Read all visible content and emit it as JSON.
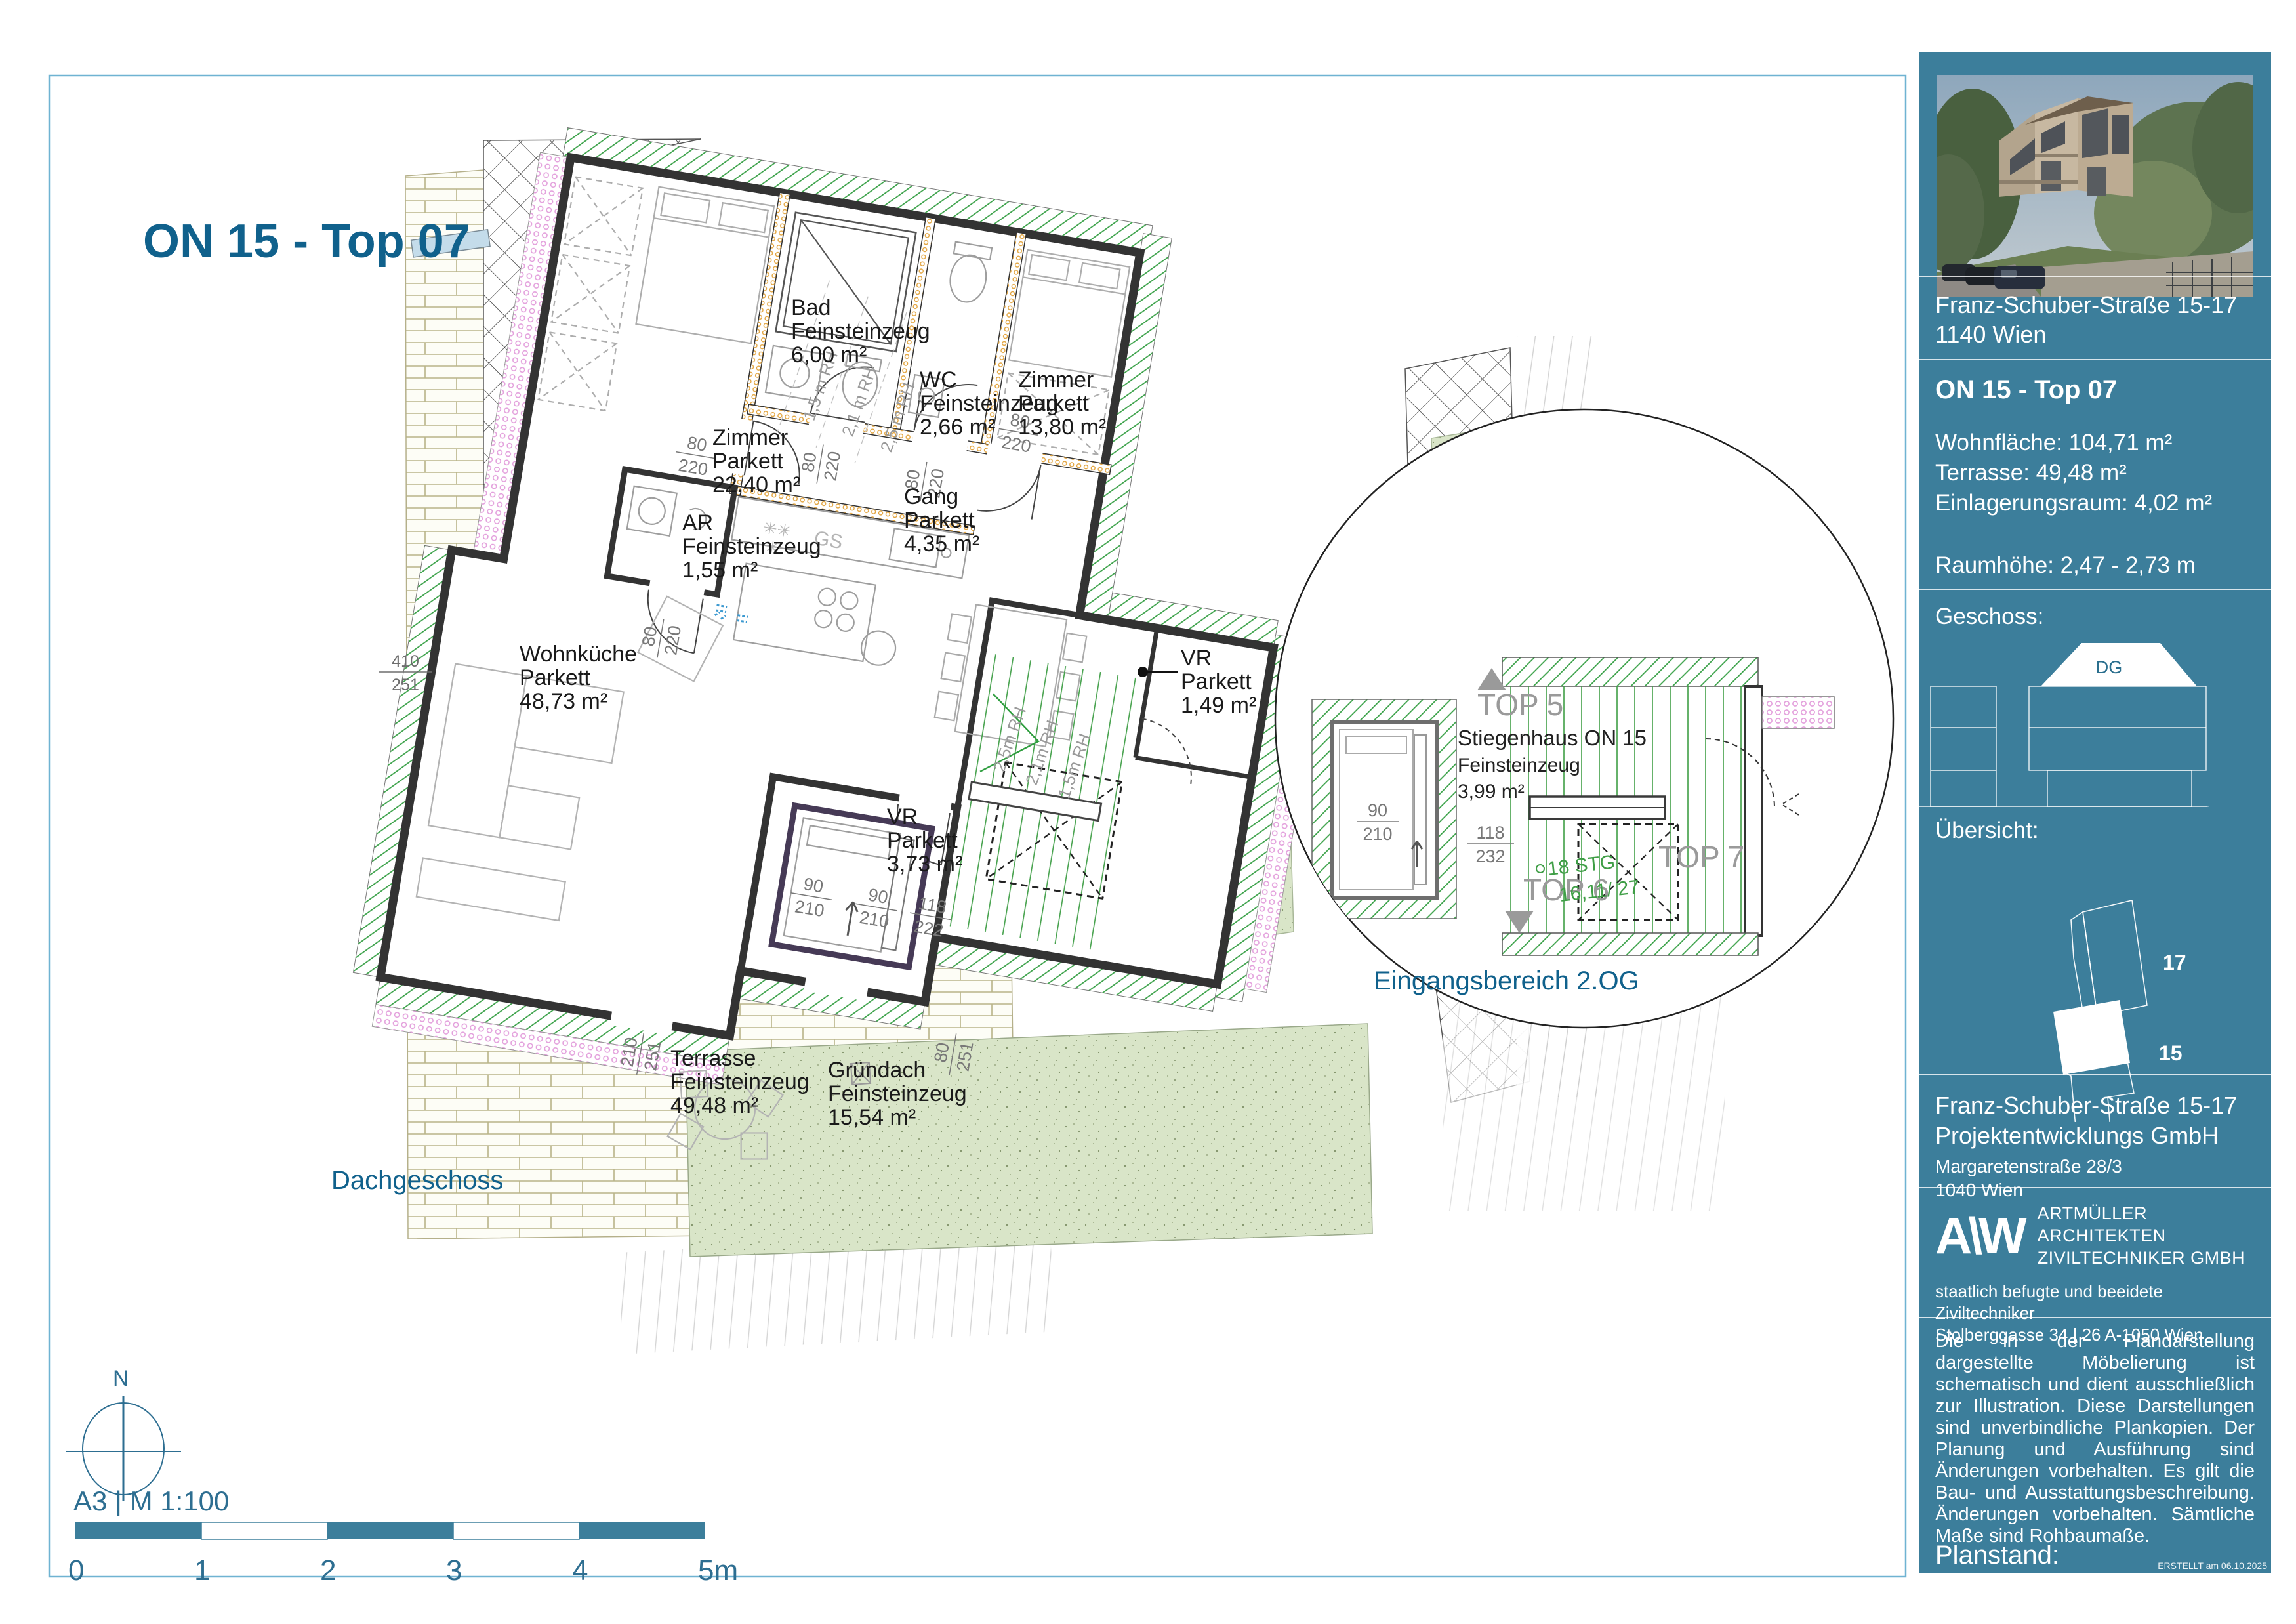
{
  "title": "ON 15 - Top 07",
  "plan": {
    "floor_label": "Dachgeschoss",
    "north_label": "N",
    "scale_text": "A3  |  M 1:100",
    "scale_ticks": [
      "0",
      "1",
      "2",
      "3",
      "4",
      "5m"
    ],
    "door_dim_w": "80",
    "door_dim_h": "220",
    "left_dim_top": "410",
    "left_dim_bot": "251",
    "bottom_dim1_top": "210",
    "bottom_dim1_bot": "251",
    "bottom_dim2_top": "80",
    "bottom_dim2_bot": "251",
    "vr_dim1_top": "90",
    "vr_dim1_bot": "210",
    "vr_dim2_top": "90",
    "vr_dim2_bot": "210",
    "vr_dim3_top": "118",
    "vr_dim3_bot": "222",
    "gs_label": "GS",
    "rh_left": [
      "1,5 m RH",
      "2,1 m RH",
      "2,5 m RH"
    ],
    "rh_right": [
      "2,5m RH",
      "2,1m RH",
      "1,5m RH"
    ],
    "rooms": [
      {
        "name": "Zimmer",
        "floor": "Parkett",
        "area": "22,40 m²"
      },
      {
        "name": "Bad",
        "floor": "Feinsteinzeug",
        "area": "6,00 m²"
      },
      {
        "name": "WC",
        "floor": "Feinsteinzeug",
        "area": "2,66 m²"
      },
      {
        "name": "Zimmer",
        "floor": "Parkett",
        "area": "13,80 m²"
      },
      {
        "name": "Gang",
        "floor": "Parkett",
        "area": "4,35 m²"
      },
      {
        "name": "AR",
        "floor": "Feinsteinzeug",
        "area": "1,55 m²"
      },
      {
        "name": "Wohnküche",
        "floor": "Parkett",
        "area": "48,73 m²"
      },
      {
        "name": "VR",
        "floor": "Parkett",
        "area": "3,73 m²"
      },
      {
        "name": "VR",
        "floor": "Parkett",
        "area": "1,49 m²"
      },
      {
        "name": "Terrasse",
        "floor": "Feinsteinzeug",
        "area": "49,48 m²"
      },
      {
        "name": "Gründach",
        "floor": "Feinsteinzeug",
        "area": "15,54 m²"
      }
    ]
  },
  "detail": {
    "caption": "Eingangsbereich 2.OG",
    "top5": "TOP 5",
    "top6": "TOP 6",
    "top7": "TOP 7",
    "room_name": "Stiegenhaus ON 15",
    "room_floor": "Feinsteinzeug",
    "room_area": "3,99 m²",
    "dim1_top": "90",
    "dim1_bot": "210",
    "dim2_top": "118",
    "dim2_bot": "232",
    "stair_note1": "18 STG",
    "stair_note2": "16,11/ 27"
  },
  "sidebar": {
    "address_line1": "Franz-Schuber-Straße 15-17",
    "address_line2": "1140 Wien",
    "unit_title": "ON 15 - Top 07",
    "area1": "Wohnfläche: 104,71 m²",
    "area2": "Terrasse: 49,48  m²",
    "area3": "Einlagerungsraum: 4,02 m²",
    "room_height": "Raumhöhe:  2,47 - 2,73 m",
    "geschoss_label": "Geschoss:",
    "geschoss_dg": "DG",
    "uebersicht_label": "Übersicht:",
    "site_label_17": "17",
    "site_label_15": "15",
    "dev_line1": "Franz-Schuber-Straße 15-17",
    "dev_line2": "Projektentwicklungs GmbH",
    "dev_line3": "Margaretenstraße 28/3",
    "dev_line4": "1040 Wien",
    "logo_text": "A\\W",
    "arch_line1": "ARTMÜLLER ARCHITEKTEN",
    "arch_line2": "ZIVILTECHNIKER GMBH",
    "arch_line3": "staatlich befugte und beeidete Ziviltechniker",
    "arch_line4": "Stolberggasse 34  |  26      A-1050 Wien",
    "disclaimer": "Die in der Plandarstellung dargestellte Möbelierung ist schematisch und dient ausschließlich zur Illustration. Diese Darstellungen sind unverbindliche Plankopien. Der Planung und Ausführung sind Änderungen vorbehalten. Es gilt die Bau- und Ausstattungsbeschreibung. Änderungen vorbehalten. Sämtliche Maße sind Rohbaumaße.",
    "planstand_label": "Planstand:",
    "created_note": "ERSTELLT am 06.10.2025"
  }
}
